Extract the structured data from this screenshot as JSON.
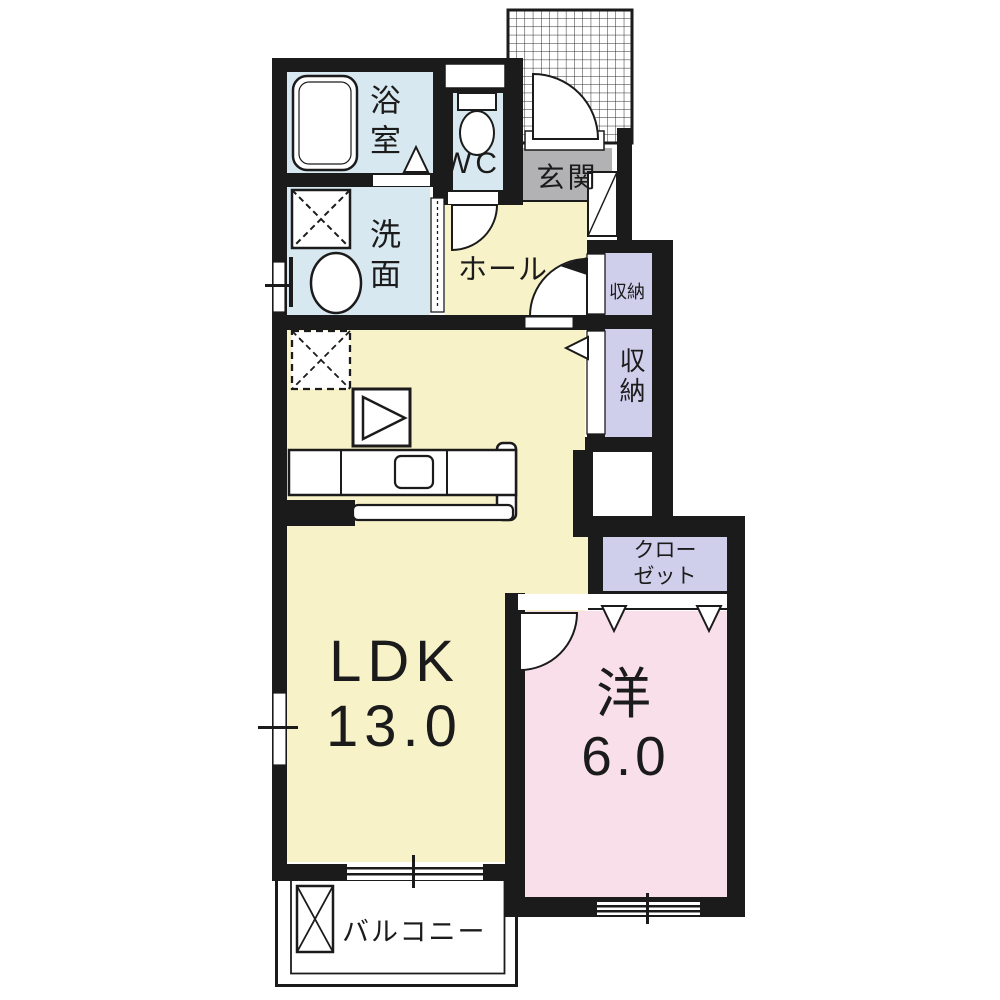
{
  "plan_title": "1LDK apartment floor plan",
  "colors": {
    "wall": "#1b1b1b",
    "room_cream": "#f8f2c9",
    "room_blue": "#d8e8f1",
    "room_pink": "#f9dfe9",
    "room_lavender": "#cfcfec",
    "room_gray": "#b2b2b4",
    "grid_line": "#2a2a2a",
    "fixture_white": "#ffffff"
  },
  "rooms": {
    "bath": {
      "label": "浴室"
    },
    "wc": {
      "label": "WC"
    },
    "washroom": {
      "label": "洗面"
    },
    "entrance": {
      "label": "玄関"
    },
    "hall": {
      "label": "ホール"
    },
    "storage_upper": {
      "label": "収納"
    },
    "storage_lower": {
      "label": "収納"
    },
    "closet": {
      "line1": "クロー",
      "line2": "ゼット"
    },
    "ldk": {
      "label": "LDK",
      "size": "13.0"
    },
    "western": {
      "label": "洋",
      "size": "6.0"
    },
    "balcony": {
      "label": "バルコニー"
    }
  },
  "icons": [
    "bathtub-icon",
    "toilet-icon",
    "washing-machine-space-icon",
    "washbasin-icon",
    "refrigerator-space-icon",
    "appliance-box-icon",
    "kitchen-counter-icon",
    "sink-icon",
    "shoe-cabinet-icon",
    "entrance-door-icon",
    "porch-grid-icon",
    "door-arc-icon",
    "folding-door-triangle-icon",
    "window-icon",
    "balcony-box-icon",
    "accordion-door-icon"
  ]
}
